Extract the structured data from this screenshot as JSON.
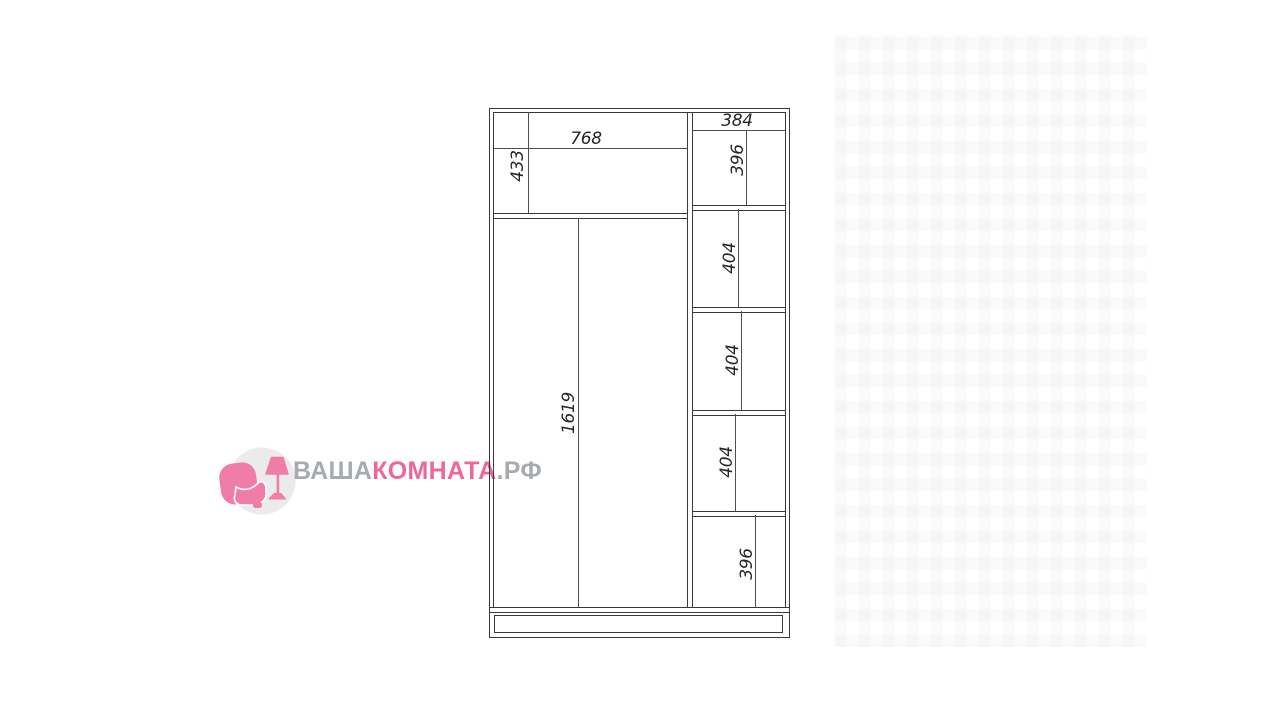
{
  "watermark": {
    "brand_gray_1": "ВАША",
    "brand_pink": "КОМНАТА",
    "brand_gray_2": ".РФ",
    "colors": {
      "text_gray": "#a7abb0",
      "text_pink": "#ee679c",
      "icon_pink": "#f07da8",
      "icon_circle": "#ebebeb"
    }
  },
  "drawing": {
    "kind": "wardrobe-dimension-diagram",
    "line_color": "#393939",
    "left_section": {
      "top_width": "768",
      "top_height": "433",
      "main_height": "1619"
    },
    "right_section": {
      "top_width": "384",
      "section_heights": [
        "396",
        "404",
        "404",
        "404",
        "396"
      ]
    }
  }
}
